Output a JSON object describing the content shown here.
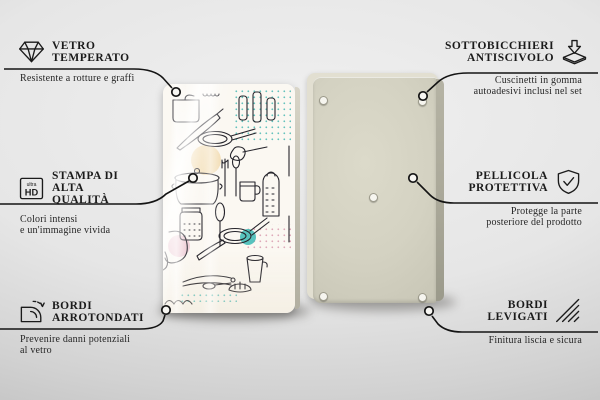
{
  "callouts": {
    "vetro": {
      "title1": "VETRO",
      "title2": "TEMPERATO",
      "sub1": "Resistente a rotture e graffi",
      "sub2": "",
      "icon": "diamond-icon"
    },
    "stampa": {
      "title1": "STAMPA DI ALTA",
      "title2": "QUALITÀ",
      "sub1": "Colori intensi",
      "sub2": "e un'immagine vivida",
      "icon": "ultra-hd-icon",
      "icon_text_small": "ultra",
      "icon_text_big": "HD"
    },
    "bordi_arrotondati": {
      "title1": "BORDI",
      "title2": "ARROTONDATI",
      "sub1": "Prevenire danni potenziali",
      "sub2": "al vetro",
      "icon": "rounded-corner-icon"
    },
    "sottobicchieri": {
      "title1": "SOTTOBICCHIERI",
      "title2": "ANTISCIVOLO",
      "sub1": "Cuscinetti in gomma",
      "sub2": "autoadesivi inclusi nel set",
      "icon": "coaster-arrow-icon"
    },
    "pellicola": {
      "title1": "PELLICOLA",
      "title2": "PROTETTIVA",
      "sub1": "Protegge la parte",
      "sub2": "posteriore del prodotto",
      "icon": "shield-check-icon"
    },
    "bordi_levigati": {
      "title1": "BORDI",
      "title2": "LEVIGATI",
      "sub1": "Finitura liscia e sicura",
      "sub2": "",
      "icon": "hatching-icon"
    }
  },
  "panels": {
    "front": "glass-panel-kitchen-utensils-print",
    "back": "rear-panel-with-antislip-pads",
    "pads_count": 5
  },
  "colors": {
    "line": "#141414",
    "back_panel": "#d4d2c2",
    "print_teal": "#46b7b2",
    "print_pink": "#d795aa",
    "print_cream": "#f3deb6",
    "background": "#dcdcdc"
  }
}
